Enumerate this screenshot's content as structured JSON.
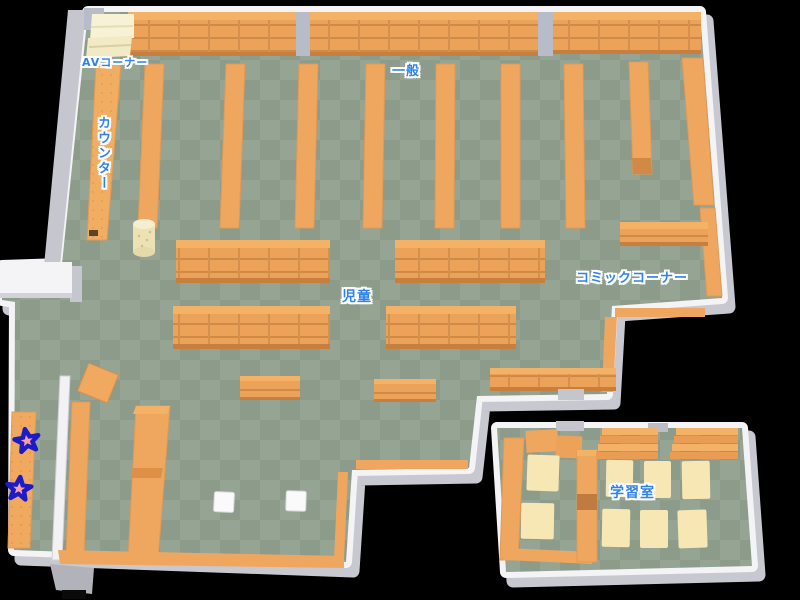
{
  "map": {
    "title": "library-floor-map",
    "regions": {
      "av_corner": "AVコーナー",
      "general": "一般",
      "counter": "カウンター",
      "children": "児童",
      "comic_corner": "コミックコーナー",
      "study_room": "学習室"
    },
    "markers": [
      {
        "shape": "star",
        "position": "left-shelf-upper"
      },
      {
        "shape": "star",
        "position": "left-shelf-lower"
      }
    ],
    "colors": {
      "background": "#000000",
      "floor_light": "#96A494",
      "floor_dark": "#8C9B8A",
      "shelf_orange": "#EDA25A",
      "shelf_top": "#F3B266",
      "shelf_line": "#CE8A48",
      "wall_white": "#F4F4F6",
      "wall_gray": "#C8C8D0",
      "label_blue": "#2E83EA",
      "marker_outline_blue": "#1B1BC8",
      "marker_fill_pink": "#E8505C",
      "av_cream": "#F1EAC4",
      "table_cream": "#F6E7B4"
    }
  }
}
